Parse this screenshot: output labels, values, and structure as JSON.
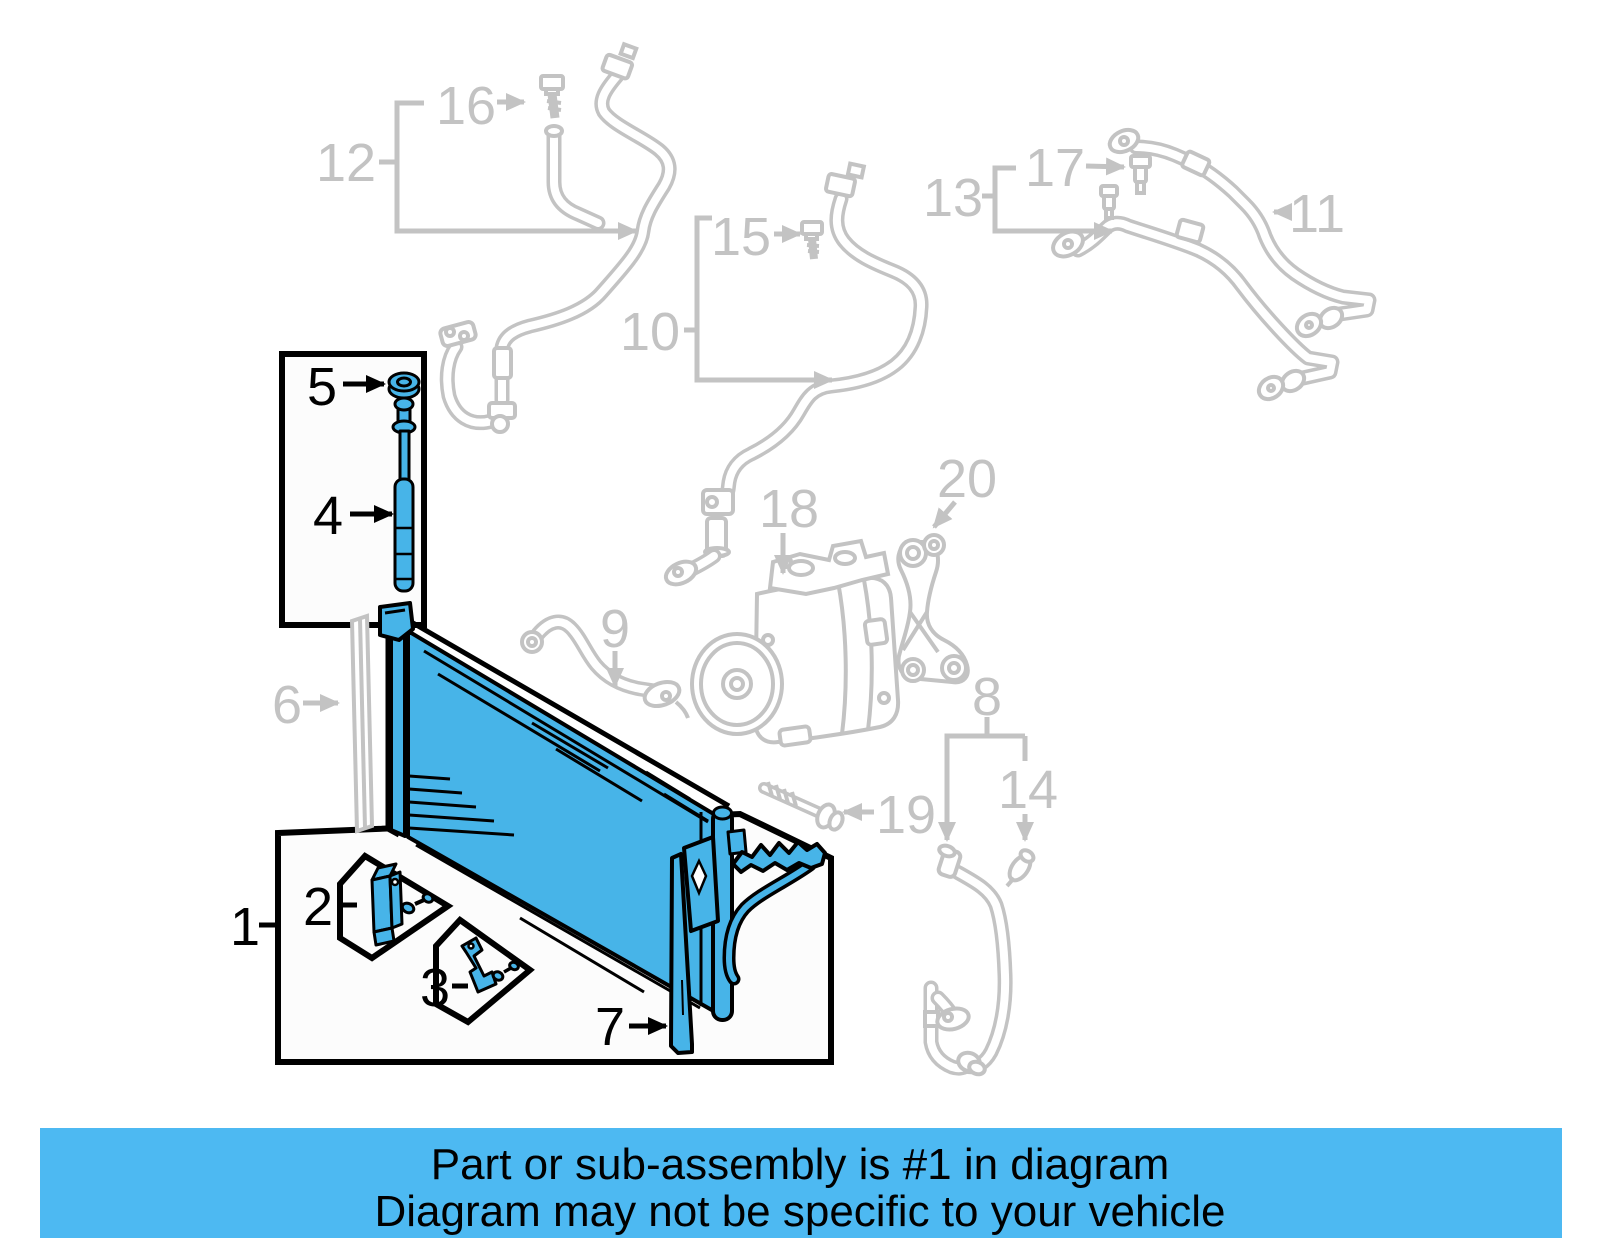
{
  "banner": {
    "line1": "Part or sub-assembly is #1 in diagram",
    "line2": "Diagram may not be specific to your vehicle"
  },
  "colors": {
    "highlight": "#47b4e8",
    "muted": "#c3c3c3",
    "outline": "#000000",
    "banner_bg": "#4db9f2",
    "box_fill": "#fcfcfc",
    "page_bg": "#ffffff"
  },
  "highlighted_part": "1",
  "callouts": {
    "c1": {
      "label": "1",
      "x": 245,
      "y": 945,
      "tone": "black"
    },
    "c2": {
      "label": "2",
      "x": 318,
      "y": 925,
      "tone": "black"
    },
    "c3": {
      "label": "3",
      "x": 435,
      "y": 1006,
      "tone": "black"
    },
    "c4": {
      "label": "4",
      "x": 328,
      "y": 534,
      "tone": "black"
    },
    "c5": {
      "label": "5",
      "x": 322,
      "y": 405,
      "tone": "black"
    },
    "c6": {
      "label": "6",
      "x": 287,
      "y": 723,
      "tone": "gray"
    },
    "c7": {
      "label": "7",
      "x": 610,
      "y": 1045,
      "tone": "black"
    },
    "c8": {
      "label": "8",
      "x": 987,
      "y": 715,
      "tone": "gray"
    },
    "c9": {
      "label": "9",
      "x": 615,
      "y": 647,
      "tone": "gray"
    },
    "c10": {
      "label": "10",
      "x": 650,
      "y": 350,
      "tone": "gray"
    },
    "c11": {
      "label": "11",
      "x": 1317,
      "y": 232,
      "tone": "gray"
    },
    "c12": {
      "label": "12",
      "x": 346,
      "y": 181,
      "tone": "gray"
    },
    "c13": {
      "label": "13",
      "x": 953,
      "y": 216,
      "tone": "gray"
    },
    "c14": {
      "label": "14",
      "x": 1028,
      "y": 808,
      "tone": "gray"
    },
    "c15": {
      "label": "15",
      "x": 741,
      "y": 255,
      "tone": "gray"
    },
    "c16": {
      "label": "16",
      "x": 466,
      "y": 124,
      "tone": "gray"
    },
    "c17": {
      "label": "17",
      "x": 1055,
      "y": 186,
      "tone": "gray"
    },
    "c18": {
      "label": "18",
      "x": 789,
      "y": 527,
      "tone": "gray"
    },
    "c19": {
      "label": "19",
      "x": 906,
      "y": 833,
      "tone": "gray"
    },
    "c20": {
      "label": "20",
      "x": 967,
      "y": 497,
      "tone": "gray"
    }
  }
}
